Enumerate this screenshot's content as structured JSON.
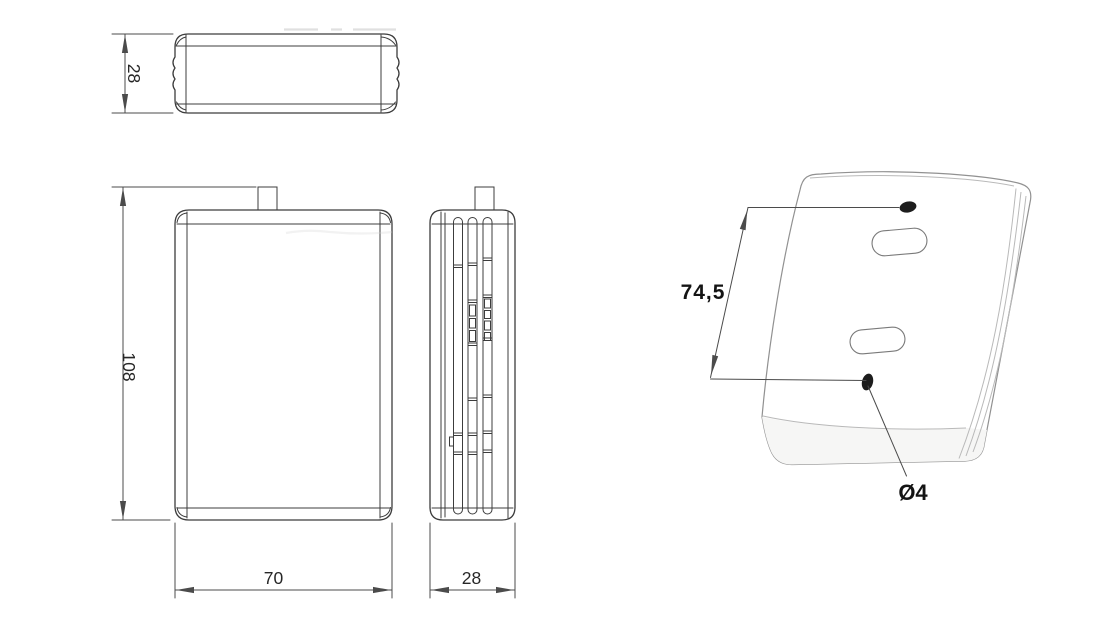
{
  "colors": {
    "bg": "#ffffff",
    "line": "#3c3c3c",
    "dim": "#4b4b4b",
    "text": "#272727",
    "label": "#141414",
    "iso_outline": "#919191",
    "iso_detail": "#b9b9b9",
    "iso_face_hi": "#ffffff",
    "iso_face_lo": "#f1f1f0",
    "iso_bottom": "#f6f6f5",
    "iso_boundary": "#d4d4d2",
    "hole": "#1d1d1d",
    "faint": "#d0d0d0"
  },
  "views": {
    "top": {
      "dimension_depth": "28"
    },
    "front": {
      "dimension_height": "108",
      "dimension_width": "70"
    },
    "side": {
      "dimension_depth": "28"
    },
    "iso": {
      "dimension_hole_spacing": "74,5",
      "dimension_hole_diameter": "Ø4"
    }
  }
}
